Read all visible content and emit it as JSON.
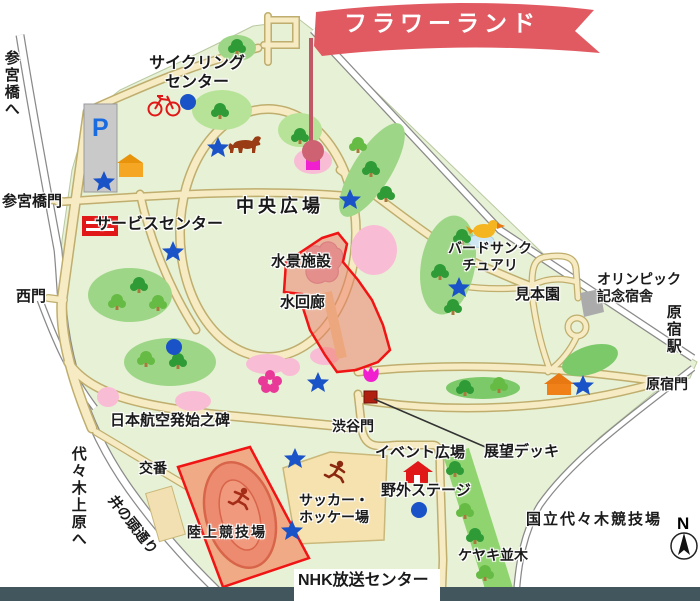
{
  "banner": {
    "title": "フラワーランド",
    "ribbon_color": "#e15a62"
  },
  "labels": {
    "cycling_center": {
      "text": "サイクリング\nセンター"
    },
    "sangubashi_to": {
      "text": "参宮橋へ"
    },
    "sangubashi_gate": {
      "text": "参宮橋門"
    },
    "service_center": {
      "text": "サービスセンター"
    },
    "west_gate": {
      "text": "西門"
    },
    "central_plaza": {
      "text": "中央広場"
    },
    "water_facility": {
      "text": "水景施設"
    },
    "water_corridor": {
      "text": "水回廊"
    },
    "bird_sanctuary": {
      "text": "バードサンク\nチュアリ"
    },
    "sample_garden": {
      "text": "見本園"
    },
    "olympic_lodge": {
      "text": "オリンピック\n記念宿舎"
    },
    "harajuku_station": {
      "text": "原宿駅"
    },
    "harajuku_gate": {
      "text": "原宿門"
    },
    "aviation_monument": {
      "text": "日本航空発始之碑"
    },
    "shibuya_gate": {
      "text": "渋谷門"
    },
    "event_plaza": {
      "text": "イベント広場"
    },
    "observation_deck": {
      "text": "展望デッキ"
    },
    "outdoor_stage": {
      "text": "野外ステージ"
    },
    "soccer_hockey": {
      "text": "サッカー・\nホッケー場"
    },
    "police_box": {
      "text": "交番"
    },
    "athletics_field": {
      "text": "陸上競技場"
    },
    "yoyogi_uehara": {
      "text": "代々木上原へ"
    },
    "inokashira_street": {
      "text": "井の頭通り"
    },
    "keyaki_row": {
      "text": "ケヤキ並木"
    },
    "national_stadium": {
      "text": "国立代々木競技場"
    },
    "nhk_center": {
      "text": "NHK放送センター"
    },
    "parking": {
      "text": "P"
    },
    "compass_north": {
      "text": "N"
    }
  },
  "icons": {
    "pin": "location-pin",
    "bicycle": "bicycle-icon",
    "dog": "dog-icon",
    "runner": "runner-icon",
    "bird": "bird-icon",
    "star": "spot-star-icon",
    "flower": "cherry-blossom-icon",
    "tulip": "tulip-icon",
    "house": "facility-house-icon"
  },
  "colors": {
    "park_green": "#e7f1d6",
    "path_tan": "#f6ebc2",
    "highlight_red": "#f01414",
    "highlight_fill": "#ef7a63",
    "marker_blue": "#1a52c8",
    "pink_area": "#f8bdd5",
    "magenta": "#f020d0",
    "banner_red": "#e15a62",
    "footer_bar": "#42565e"
  }
}
